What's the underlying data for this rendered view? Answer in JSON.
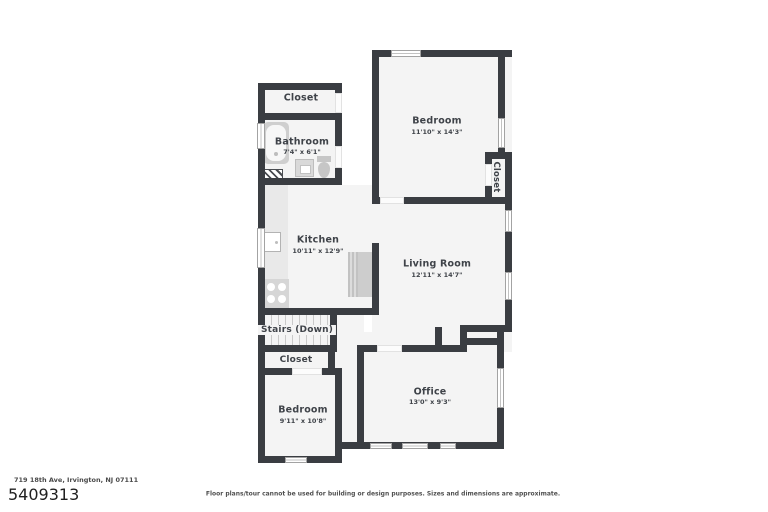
{
  "floorplan": {
    "rooms": {
      "closet_top": {
        "name": "Closet"
      },
      "bathroom": {
        "name": "Bathroom",
        "dims": "7'4\" x 6'1\""
      },
      "bedroom_top": {
        "name": "Bedroom",
        "dims": "11'10\" x 14'3\""
      },
      "closet_right": {
        "name": "Closet"
      },
      "kitchen": {
        "name": "Kitchen",
        "dims": "10'11\" x 12'9\""
      },
      "living_room": {
        "name": "Living Room",
        "dims": "12'11\" x 14'7\""
      },
      "stairs": {
        "name": "Stairs (Down)"
      },
      "closet_bottom": {
        "name": "Closet"
      },
      "bedroom_bottom": {
        "name": "Bedroom",
        "dims": "9'11\" x 10'8\""
      },
      "office": {
        "name": "Office",
        "dims": "13'0\" x 9'3\""
      }
    },
    "fixtures": [
      "bathtub",
      "bathroom-sink",
      "toilet",
      "shower-hatch",
      "kitchen-counter",
      "kitchen-sink",
      "stove",
      "refrigerator",
      "stair-treads"
    ],
    "colors": {
      "wall": "#3a3d42",
      "floor": "#f4f4f4",
      "fixture": "#d4d4d4"
    }
  },
  "footer": {
    "address": "719 18th Ave, Irvington, NJ 07111",
    "mls_number": "5409313",
    "disclaimer": "Floor plans/tour cannot be used for building or design purposes. Sizes and dimensions are approximate."
  }
}
